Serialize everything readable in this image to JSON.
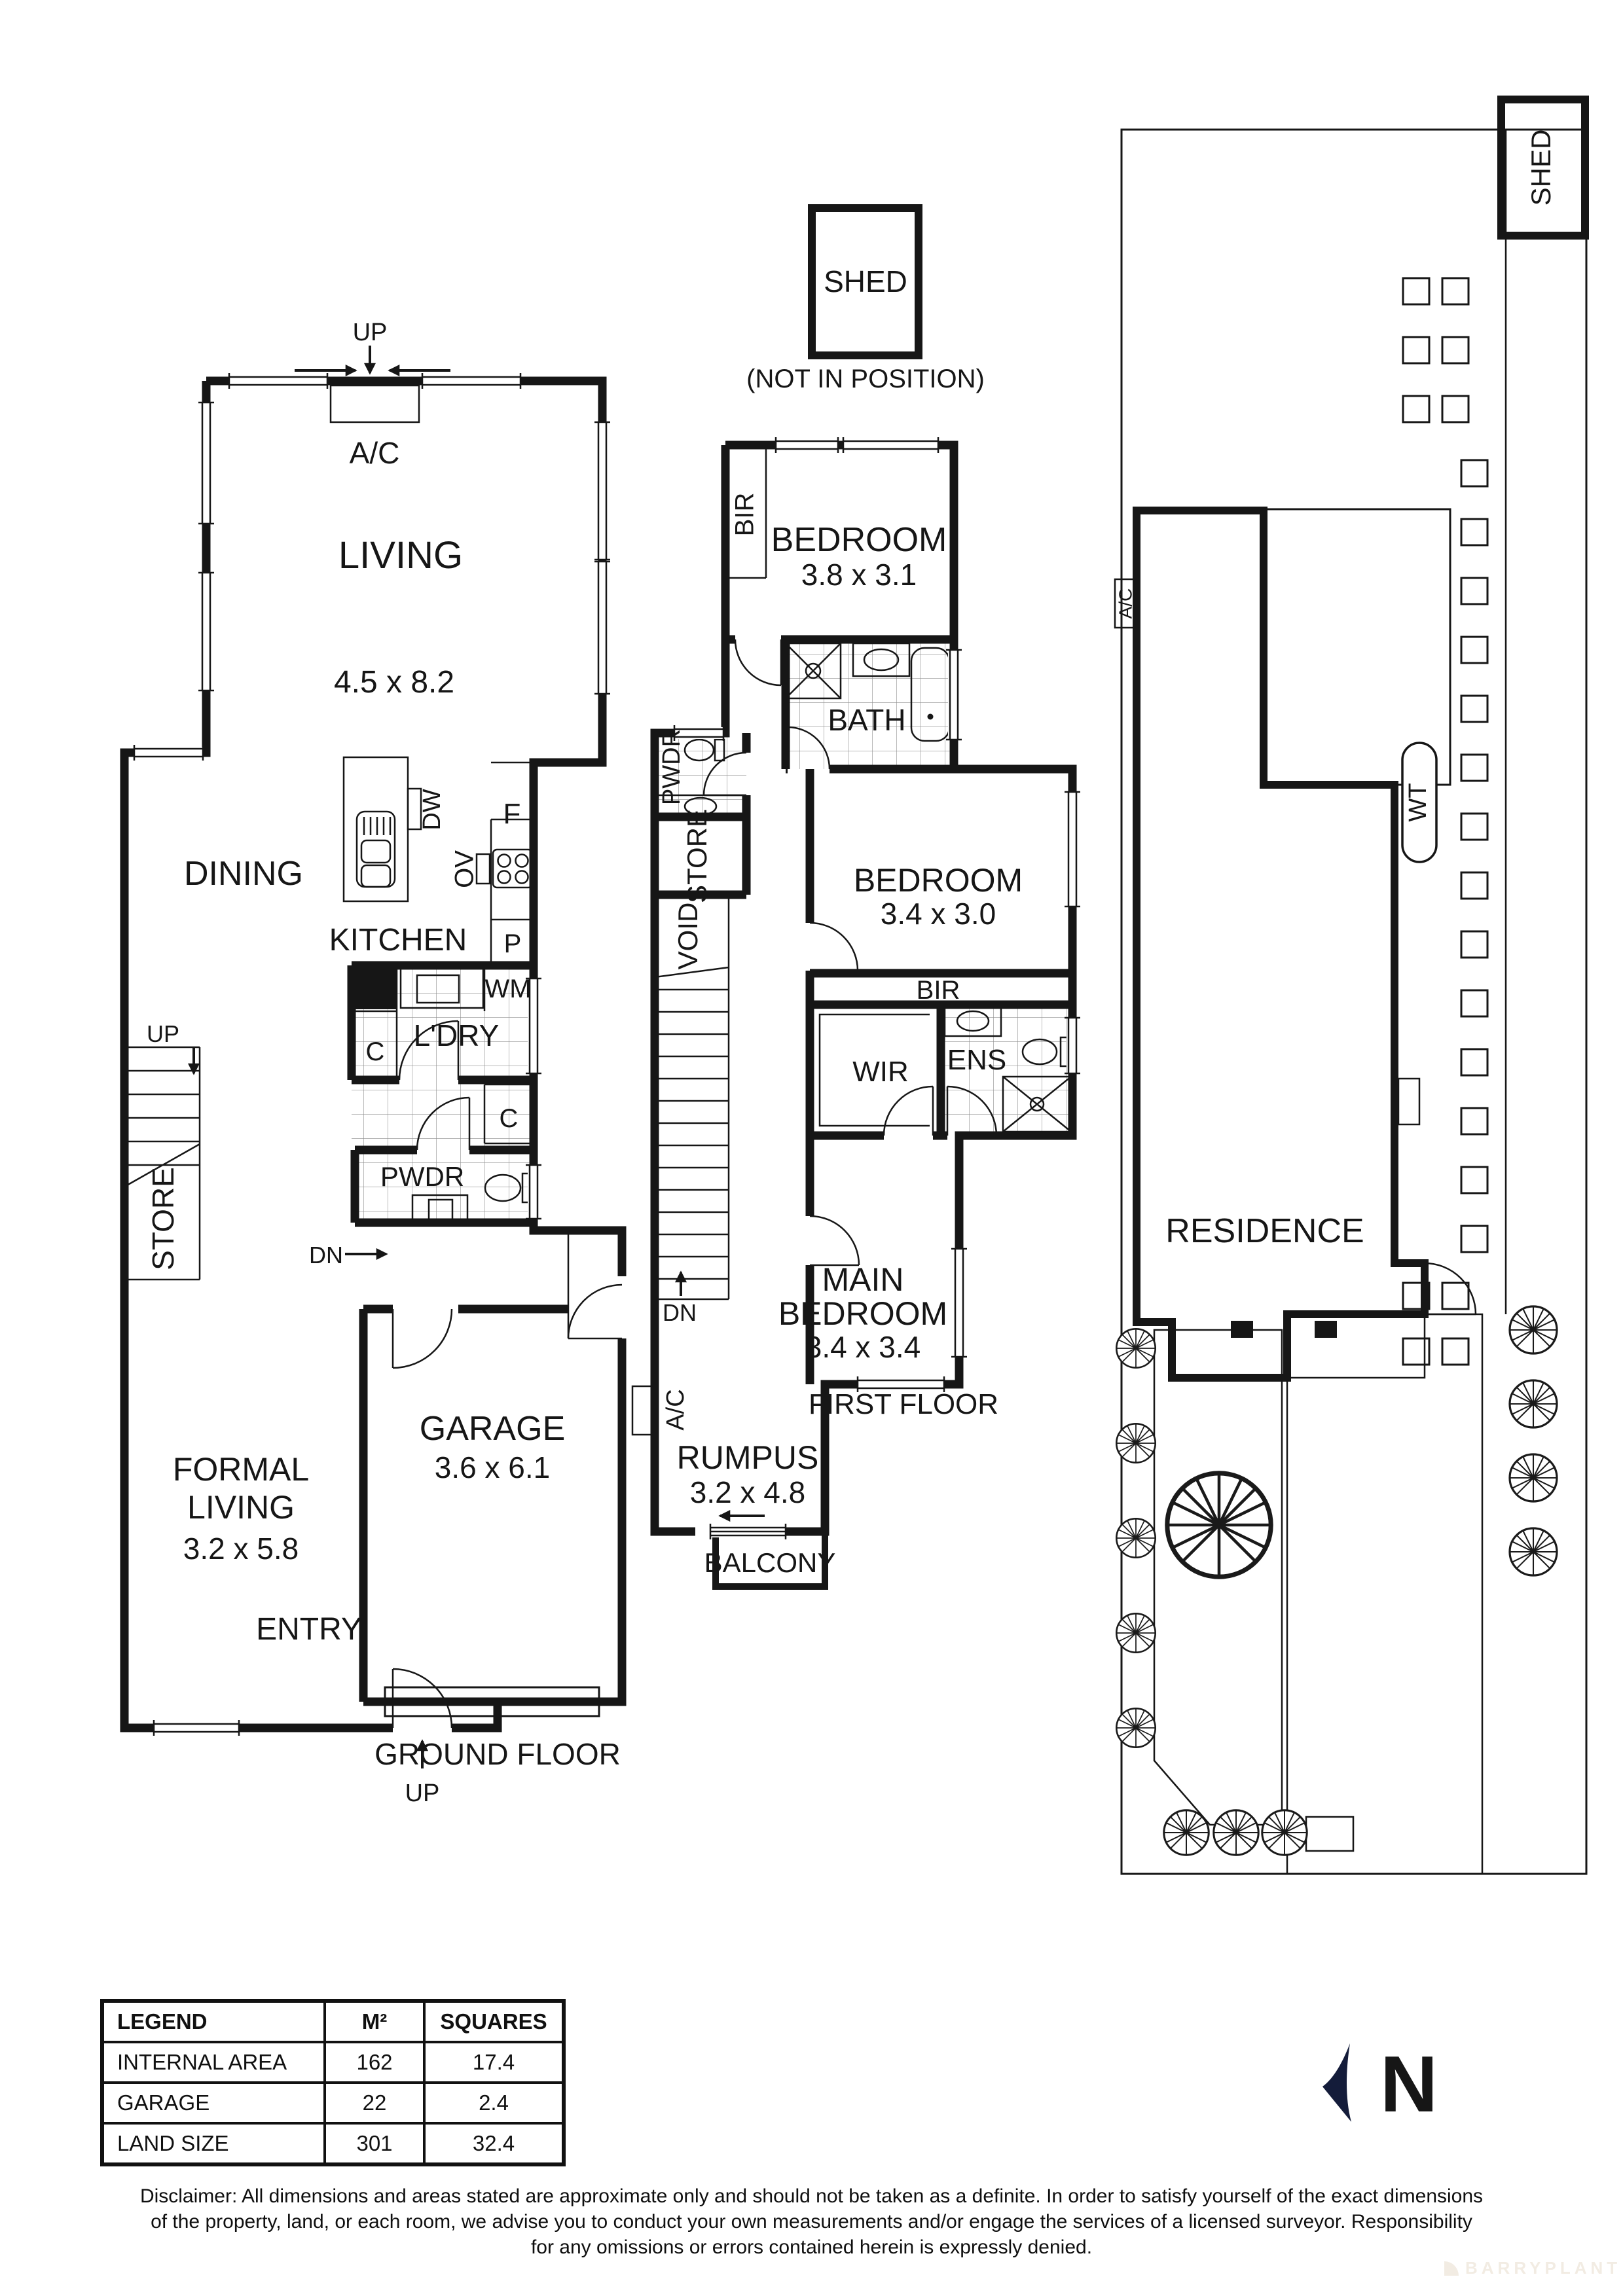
{
  "ground_floor": {
    "floor_label": "GROUND FLOOR",
    "living": "LIVING",
    "living_dims": "4.5 x 8.2",
    "dining": "DINING",
    "kitchen": "KITCHEN",
    "laundry": "L'DRY",
    "powder": "PWDR",
    "store": "STORE",
    "formal_line1": "FORMAL",
    "formal_line2": "LIVING",
    "formal_dims": "3.2 x 5.8",
    "garage": "GARAGE",
    "garage_dims": "3.6 x 6.1",
    "entry": "ENTRY",
    "up_top": "UP",
    "ac": "A/C",
    "up_stair": "UP",
    "dn": "DN",
    "up_entry": "UP",
    "dw": "DW",
    "fridge": "F",
    "oven": "OV",
    "pantry": "P",
    "washer": "WM",
    "cupboard1": "C",
    "cupboard2": "C"
  },
  "first_floor": {
    "floor_label": "FIRST FLOOR",
    "shed": "SHED",
    "shed_note": "(NOT IN POSITION)",
    "bir1": "BIR",
    "bedroom1": "BEDROOM",
    "bedroom1_dims": "3.8 x 3.1",
    "bath": "BATH",
    "powder": "PWDR",
    "store": "STORE",
    "void": "VOID",
    "bedroom2": "BEDROOM",
    "bedroom2_dims": "3.4 x 3.0",
    "bir2": "BIR",
    "wir": "WIR",
    "ens": "ENS",
    "main1": "MAIN",
    "main2": "BEDROOM",
    "main_dims": "3.4 x 3.4",
    "rumpus": "RUMPUS",
    "rumpus_dims": "3.2 x 4.8",
    "balcony": "BALCONY",
    "dn": "DN",
    "ac": "A/C"
  },
  "site_plan": {
    "residence": "RESIDENCE",
    "shed": "SHED",
    "water_tank": "WT",
    "ac": "A/C"
  },
  "north_letter": "N",
  "legend": {
    "h0": "LEGEND",
    "h1": "M²",
    "h2": "SQUARES",
    "rows": [
      [
        "INTERNAL AREA",
        "162",
        "17.4"
      ],
      [
        "GARAGE",
        "22",
        "2.4"
      ],
      [
        "LAND SIZE",
        "301",
        "32.4"
      ]
    ]
  },
  "disclaimer": {
    "line1": "Disclaimer: All dimensions and areas stated are approximate only and should not be taken as a definite. In order to satisfy yourself of the exact dimensions",
    "line2": "of the property, land, or each room, we advise you to conduct your own measurements and/or engage the services of a licensed surveyor. Responsibility",
    "line3": "for any omissions or errors contained herein is expressly denied."
  },
  "watermark": "BARRYPLANT",
  "colors": {
    "ink": "#161616",
    "site_fill": "#e9e9e9",
    "north": "#141c3a"
  }
}
